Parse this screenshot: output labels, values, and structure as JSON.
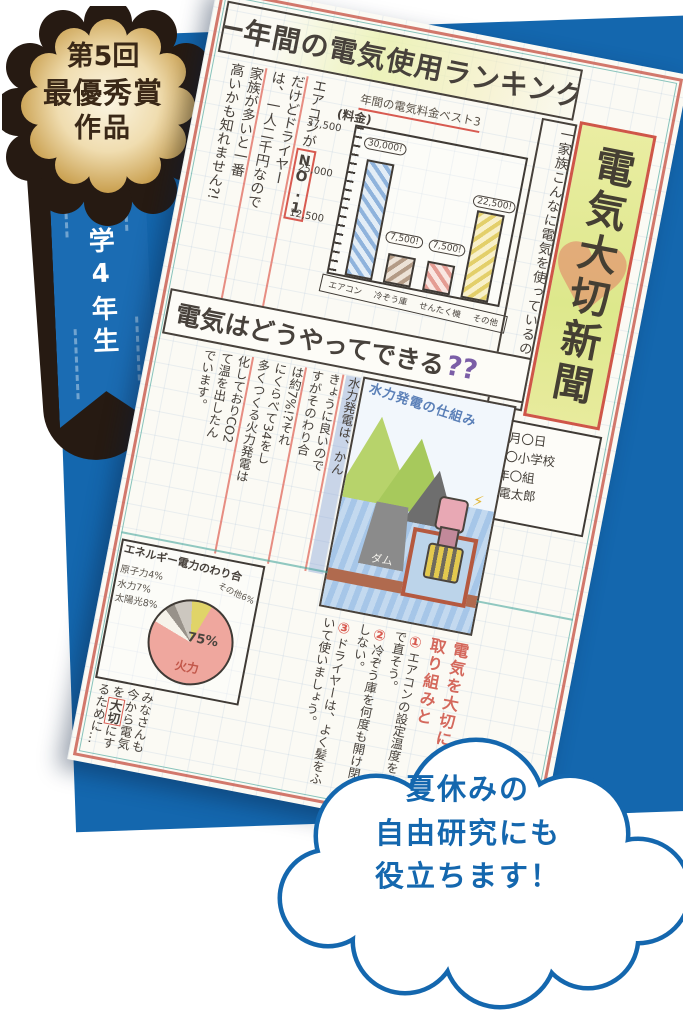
{
  "badge": {
    "top": "第5回",
    "middle": "最優秀賞",
    "bottom": "作品"
  },
  "ribbon": {
    "label": "小学4年生"
  },
  "bubble": {
    "line1": "夏休みの",
    "line2": "自由研究にも",
    "line3": "役立ちます！"
  },
  "colors": {
    "blue": "#1467ae",
    "badge_dark": "#261a12",
    "gold": "#e8cf96",
    "red_accent": "#d85a50"
  },
  "newspaper": {
    "headline1": "一年間の電気使用ランキング",
    "masthead": "電気大切新聞",
    "masthead_heart": "♥",
    "lead": "一家族こんなに電気を使っているのです。",
    "date_lines": [
      "〇月〇日",
      "〇〇小学校",
      "4年〇組",
      "九電太郎"
    ],
    "article1": {
      "col1a": "エアコンが",
      "col1b": "NO.1",
      "col2": "だけどドライヤー",
      "col3": "は、一人二千円なので",
      "col4": "家族が多いと一番",
      "col5": "高いかも知れません?!"
    },
    "headline2": {
      "main": "電気はどうやってできる",
      "marks": "??"
    },
    "article2": {
      "cols": [
        "水力発電は、かん",
        "きょうに良いので",
        "すがそのわり合",
        "は約7%!?それ",
        "にくらべて34をし",
        "多くつくる火力発電は",
        "化しておりCO2",
        "て温を出したん",
        "でいます。"
      ]
    },
    "illustration": {
      "caption": "水力発電の仕組み",
      "dam": "ダム",
      "lightning": "⚡"
    },
    "pie_box": {
      "title": "エネルギー電力のわり合",
      "side_labels": [
        "原子力4%",
        "水力7%",
        "太陽光8%"
      ],
      "other_label": "その他6%",
      "big_value": "75%",
      "big_label": "火力"
    },
    "actions": {
      "heading_a": "電気を大切に",
      "heading_b": "取り組みと",
      "items": [
        {
          "num": "①",
          "text": "エアコンの設定温度を1℃で直そう。"
        },
        {
          "num": "②",
          "text": "冷ぞう庫を何度も開け閉めしない。"
        },
        {
          "num": "③",
          "text": "ドライヤーは、よく髪をふいて使いましょう。"
        }
      ]
    },
    "closing": {
      "a": "みなさんも今から電気を",
      "b": "大切",
      "c": "にするために…"
    }
  },
  "chart_data": [
    {
      "type": "bar",
      "title": "年間の電気料金ベスト3",
      "ylabel": "(料金)",
      "categories": [
        "エアコン",
        "冷ぞう庫",
        "せんたく機",
        "その他"
      ],
      "values": [
        30000,
        7500,
        7500,
        22500
      ],
      "callouts": [
        "30,000!",
        "7,500!",
        "7,500!",
        "22,500!"
      ],
      "yticks": [
        "37,500",
        "25,000",
        "12,500"
      ],
      "ylim": [
        0,
        37500
      ],
      "colors": [
        "#8fb3dc",
        "#b39b86",
        "#e49c93",
        "#e3cf6a"
      ],
      "legend": "none",
      "grid": "notebook squares"
    },
    {
      "type": "pie",
      "title": "エネルギー電力のわり合",
      "labels": [
        "火力",
        "その他",
        "原子力",
        "水力",
        "太陽光"
      ],
      "values": [
        75,
        6,
        4,
        7,
        8
      ],
      "colors": [
        "#efa79e",
        "#f6f3ea",
        "#98928a",
        "#ccc7bf",
        "#e0d468"
      ],
      "start_angle_deg": 20
    }
  ]
}
